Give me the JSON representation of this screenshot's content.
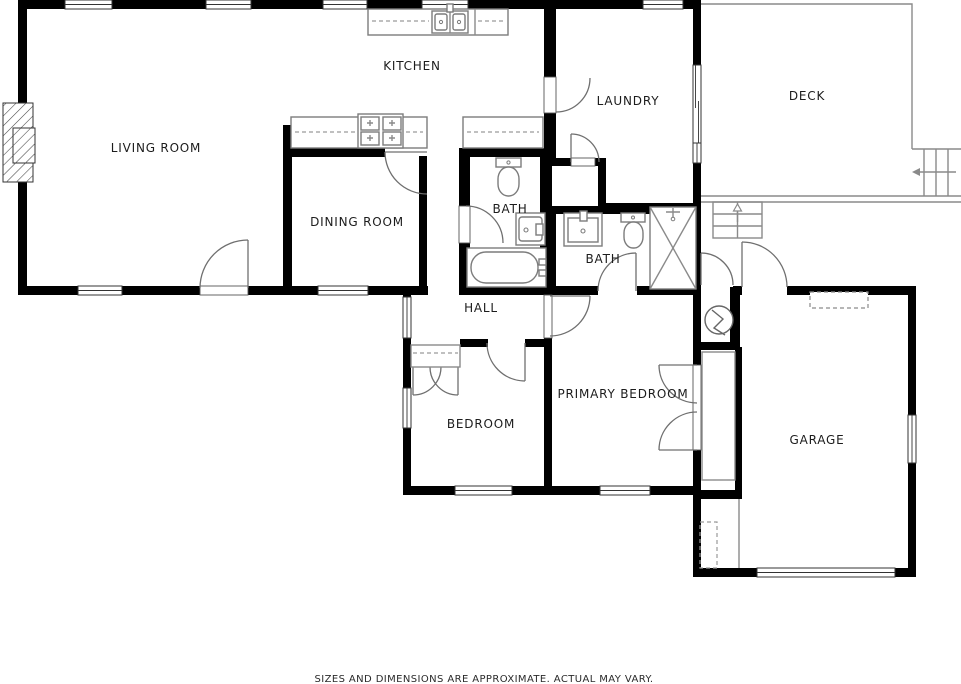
{
  "document_title": "Floor Plan",
  "rooms": {
    "living_room": {
      "label": "LIVING ROOM"
    },
    "kitchen": {
      "label": "KITCHEN"
    },
    "laundry": {
      "label": "LAUNDRY"
    },
    "deck": {
      "label": "DECK"
    },
    "dining_room": {
      "label": "DINING ROOM"
    },
    "bath_hall": {
      "label": "BATH"
    },
    "bath_primary": {
      "label": "BATH"
    },
    "hall": {
      "label": "HALL"
    },
    "bedroom": {
      "label": "BEDROOM"
    },
    "primary_bedroom": {
      "label": "PRIMARY BEDROOM"
    },
    "garage": {
      "label": "GARAGE"
    }
  },
  "footer": {
    "disclaimer": "SIZES AND DIMENSIONS ARE APPROXIMATE. ACTUAL MAY VARY."
  },
  "colors": {
    "wall": "#000000",
    "background": "#ffffff",
    "fixture_line": "#7c7c7c",
    "label_text": "#1c1c1c"
  }
}
